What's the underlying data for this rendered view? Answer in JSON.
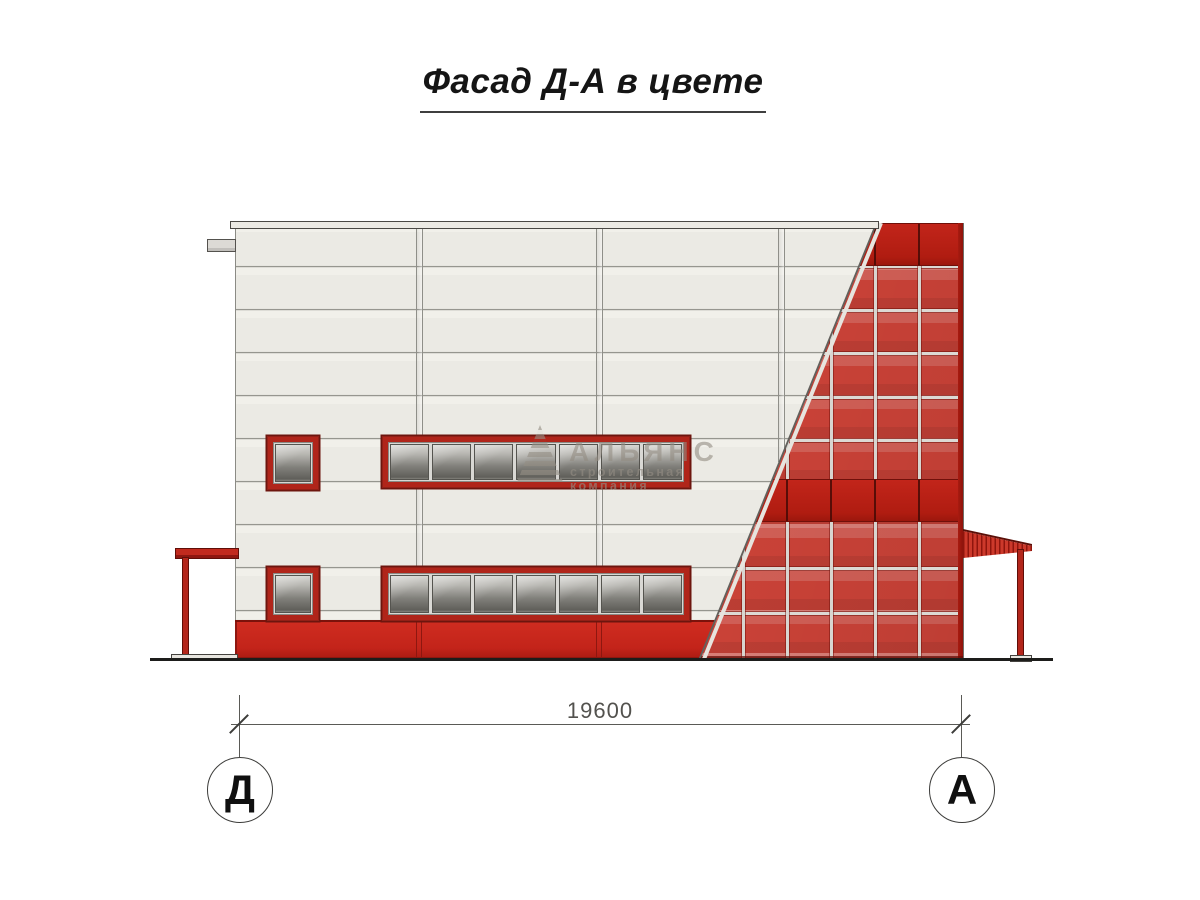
{
  "title": {
    "text": "Фасад Д-А в цвете"
  },
  "dimension": {
    "value": "19600"
  },
  "axes": {
    "left": "Д",
    "right": "А"
  },
  "watermark": {
    "name": "АЛЬЯНС",
    "tagline": "строительная компания"
  },
  "drawing": {
    "upper_strip_panes": 7,
    "lower_strip_panes": 7,
    "colors": {
      "facade_panel": "#edece6",
      "frame_red": "#b0251a",
      "glazing_red": "#d3453a",
      "dark_red_band": "#b01c11",
      "plinth_red": "#c9281d",
      "glass_gray": "#807f7a",
      "ground": "#1d1d1b"
    }
  }
}
